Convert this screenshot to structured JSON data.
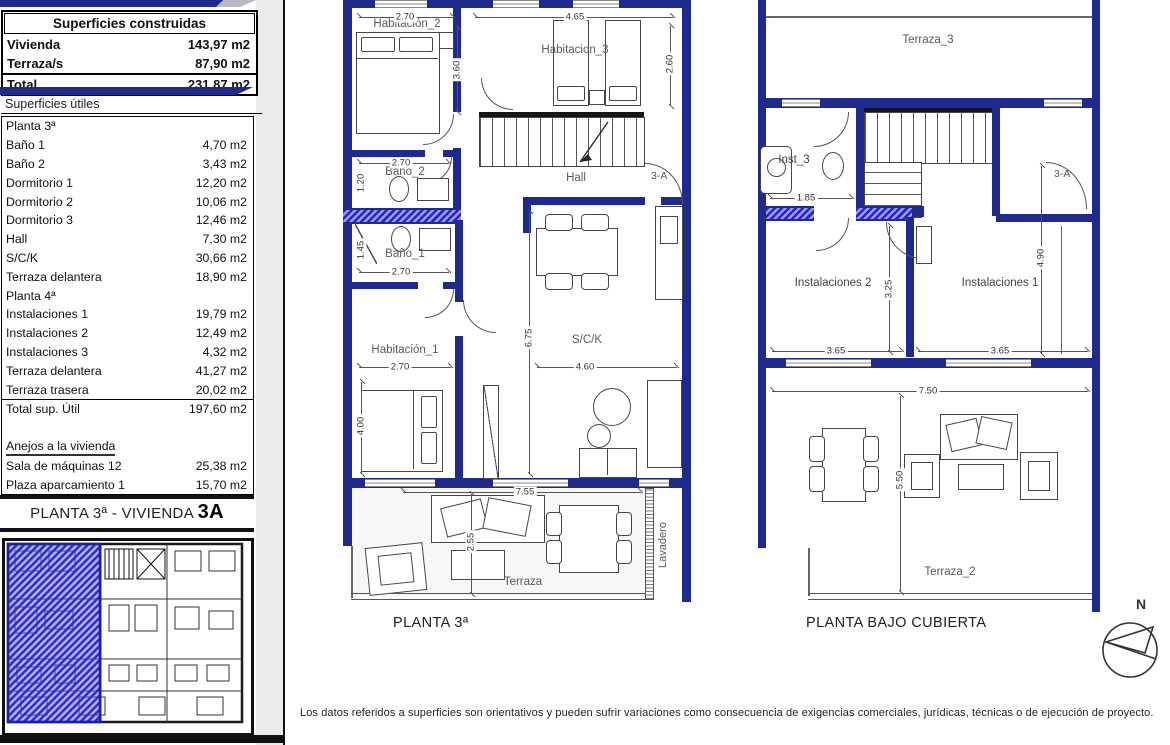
{
  "colors": {
    "wall": "#1f2b8c",
    "highlight": "#2a2ae0",
    "line": "#555555"
  },
  "sidebar": {
    "built": {
      "title": "Superficies construidas",
      "rows": [
        {
          "label": "Vivienda",
          "value": "143,97 m2"
        },
        {
          "label": "Terraza/s",
          "value": "87,90 m2"
        }
      ],
      "total": {
        "label": "Total",
        "value": "231,87 m2"
      }
    },
    "useful": {
      "title": "Superficies útiles",
      "rows": [
        {
          "label": "Planta 3ª",
          "value": "",
          "cls": "section"
        },
        {
          "label": "Baño 1",
          "value": "4,70 m2"
        },
        {
          "label": "Baño 2",
          "value": "3,43 m2"
        },
        {
          "label": "Dormitorio 1",
          "value": "12,20 m2"
        },
        {
          "label": "Dormitorio 2",
          "value": "10,06 m2"
        },
        {
          "label": "Dormitorio 3",
          "value": "12,46 m2"
        },
        {
          "label": "Hall",
          "value": "7,30 m2"
        },
        {
          "label": "S/C/K",
          "value": "30,66 m2"
        },
        {
          "label": "Terraza delantera",
          "value": "18,90 m2"
        },
        {
          "label": "Planta 4ª",
          "value": "",
          "cls": "section"
        },
        {
          "label": "Instalaciones 1",
          "value": "19,79 m2"
        },
        {
          "label": "Instalaciones 2",
          "value": "12,49 m2"
        },
        {
          "label": "Instalaciones 3",
          "value": "4,32 m2"
        },
        {
          "label": "Terraza delantera",
          "value": "41,27 m2"
        },
        {
          "label": "Terraza trasera",
          "value": "20,02 m2"
        },
        {
          "label": "Total sup. Útil",
          "value": "197,60 m2",
          "cls": "total"
        },
        {
          "label": " ",
          "value": "",
          "cls": "blank"
        },
        {
          "label": "Anejos a la vivienda",
          "value": "",
          "cls": "annex"
        },
        {
          "label": "Sala de máquinas  12",
          "value": "25,38 m2"
        },
        {
          "label": "Plaza aparcamiento 1",
          "value": "15,70 m2"
        }
      ]
    },
    "plan_title": {
      "prefix": "PLANTA 3ª - VIVIENDA ",
      "unit": "3A"
    }
  },
  "plan3": {
    "caption": "PLANTA 3ª",
    "door_label": "3-A",
    "rooms": {
      "hab2": "Habitación_2",
      "hab3": "Habitacion_3",
      "hall": "Hall",
      "bano2": "Baño_2",
      "bano1": "Baño_1",
      "hab1": "Habitación_1",
      "sck": "S/C/K",
      "terraza": "Terraza",
      "lavadero": "Lavadero"
    },
    "dims": {
      "hab2_w": "2.70",
      "hab3_w": "4.65",
      "hab3_d": "2.60",
      "left_d": "3.60",
      "bano2_w": "2.70",
      "bano2_d": "1.20",
      "bano1_d": "1.45",
      "bano1_w": "2.70",
      "hab1_w": "2.70",
      "hab1_d": "4.00",
      "sck_d": "6.75",
      "sck_w": "4.60",
      "terraza_w": "7.55",
      "terraza_d": "2.55"
    }
  },
  "planbc": {
    "caption": "PLANTA BAJO CUBIERTA",
    "door_label": "3-A",
    "compass": "N",
    "rooms": {
      "terraza3": "Terraza_3",
      "inst3": "Inst_3",
      "inst2": "Instalaciones 2",
      "inst1": "Instalaciones 1",
      "terraza2": "Terraza_2"
    },
    "dims": {
      "inst3_w": "1.85",
      "inst2_d": "3.25",
      "inst1_d": "4.90",
      "inst2_w": "3.65",
      "inst1_w": "3.65",
      "width": "7.50",
      "terraza2_d": "5.50"
    }
  },
  "page": {
    "disclaimer": "Los datos referidos a superficies son orientativos y pueden sufrir variaciones como consecuencia de exigencias comerciales, jurídicas, técnicas o de ejecución de proyecto."
  }
}
